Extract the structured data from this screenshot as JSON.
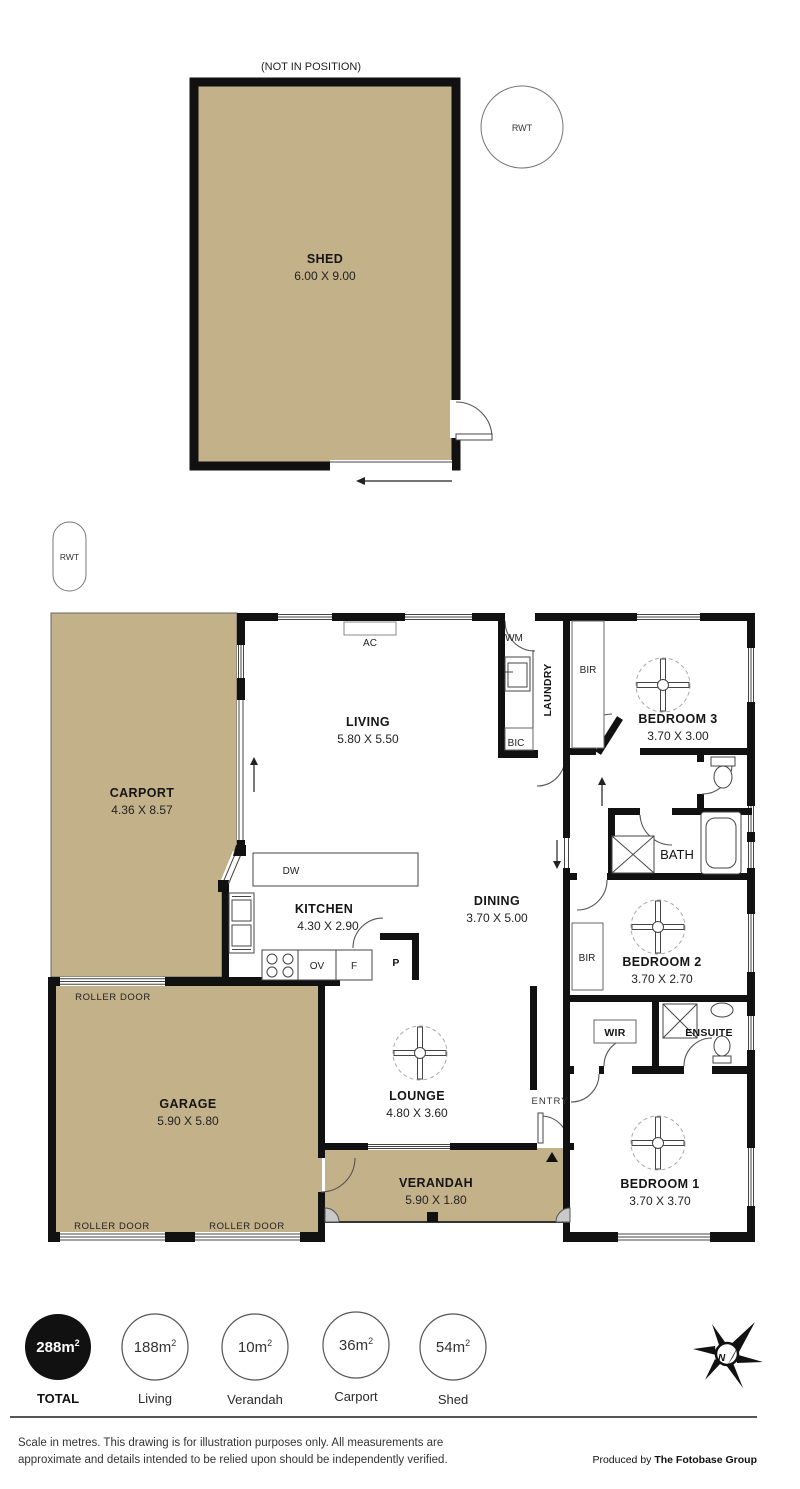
{
  "annotations": {
    "not_in_position": "(NOT IN POSITION)"
  },
  "tank": {
    "rwt": "RWT"
  },
  "rooms": {
    "shed": {
      "name": "SHED",
      "dims": "6.00 X 9.00"
    },
    "carport": {
      "name": "CARPORT",
      "dims": "4.36 X 8.57"
    },
    "living": {
      "name": "LIVING",
      "dims": "5.80 X 5.50"
    },
    "kitchen": {
      "name": "KITCHEN",
      "dims": "4.30 X 2.90"
    },
    "dining": {
      "name": "DINING",
      "dims": "3.70 X 5.00"
    },
    "laundry": {
      "name": "LAUNDRY"
    },
    "bath": {
      "name": "BATH"
    },
    "garage": {
      "name": "GARAGE",
      "dims": "5.90 X 5.80"
    },
    "lounge": {
      "name": "LOUNGE",
      "dims": "4.80 X 3.60"
    },
    "verandah": {
      "name": "VERANDAH",
      "dims": "5.90 X 1.80"
    },
    "entry": {
      "name": "ENTRY"
    },
    "wir": {
      "name": "WIR"
    },
    "ensuite": {
      "name": "ENSUITE"
    },
    "bedroom1": {
      "name": "BEDROOM 1",
      "dims": "3.70 X 3.70"
    },
    "bedroom2": {
      "name": "BEDROOM 2",
      "dims": "3.70 X 2.70"
    },
    "bedroom3": {
      "name": "BEDROOM 3",
      "dims": "3.70 X 3.00"
    }
  },
  "fixtures": {
    "ac": "AC",
    "wm": "WM",
    "bic": "BIC",
    "bir": "BIR",
    "dw": "DW",
    "ov": "OV",
    "fridge": "F",
    "pantry": "P",
    "roller_door": "ROLLER DOOR"
  },
  "legend": {
    "total": {
      "value": "288m",
      "sup": "2",
      "label": "TOTAL"
    },
    "items": [
      {
        "value": "188m",
        "sup": "2",
        "label": "Living"
      },
      {
        "value": "10m",
        "sup": "2",
        "label": "Verandah"
      },
      {
        "value": "36m",
        "sup": "2",
        "label": "Carport"
      },
      {
        "value": "54m",
        "sup": "2",
        "label": "Shed"
      }
    ]
  },
  "logo": {
    "n": "N"
  },
  "footer": {
    "disclaimer_line1": "Scale in metres. This drawing is for illustration purposes only. All measurements are",
    "disclaimer_line2": "approximate and details intended to be relied upon should be independently verified.",
    "produced_by": "Produced by ",
    "brand": "The Fotobase Group"
  },
  "colors": {
    "floor": "#c3b189",
    "wall": "#111111"
  }
}
